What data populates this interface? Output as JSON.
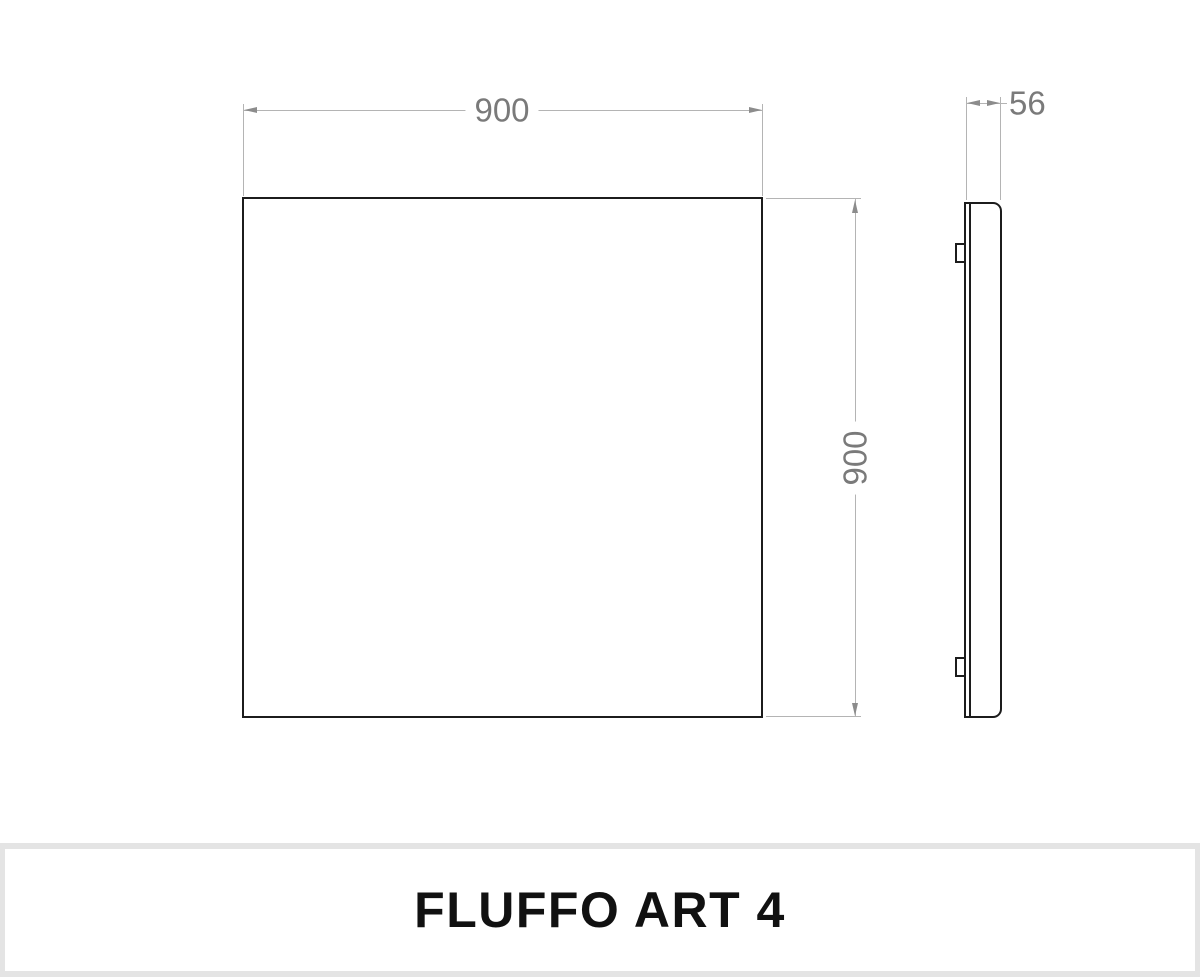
{
  "drawing": {
    "front_view": {
      "width_label": "900",
      "height_label": "900"
    },
    "side_view": {
      "depth_label": "56"
    },
    "colors": {
      "outline": "#1c1c1c",
      "dimension_line": "#b4b4b4",
      "dimension_arrow": "#8c8c8c",
      "dimension_text": "#7a7a7a",
      "footer_band": "#e4e4e4",
      "background": "#ffffff",
      "title_text": "#111111"
    }
  },
  "footer": {
    "title": "FLUFFO ART 4"
  }
}
